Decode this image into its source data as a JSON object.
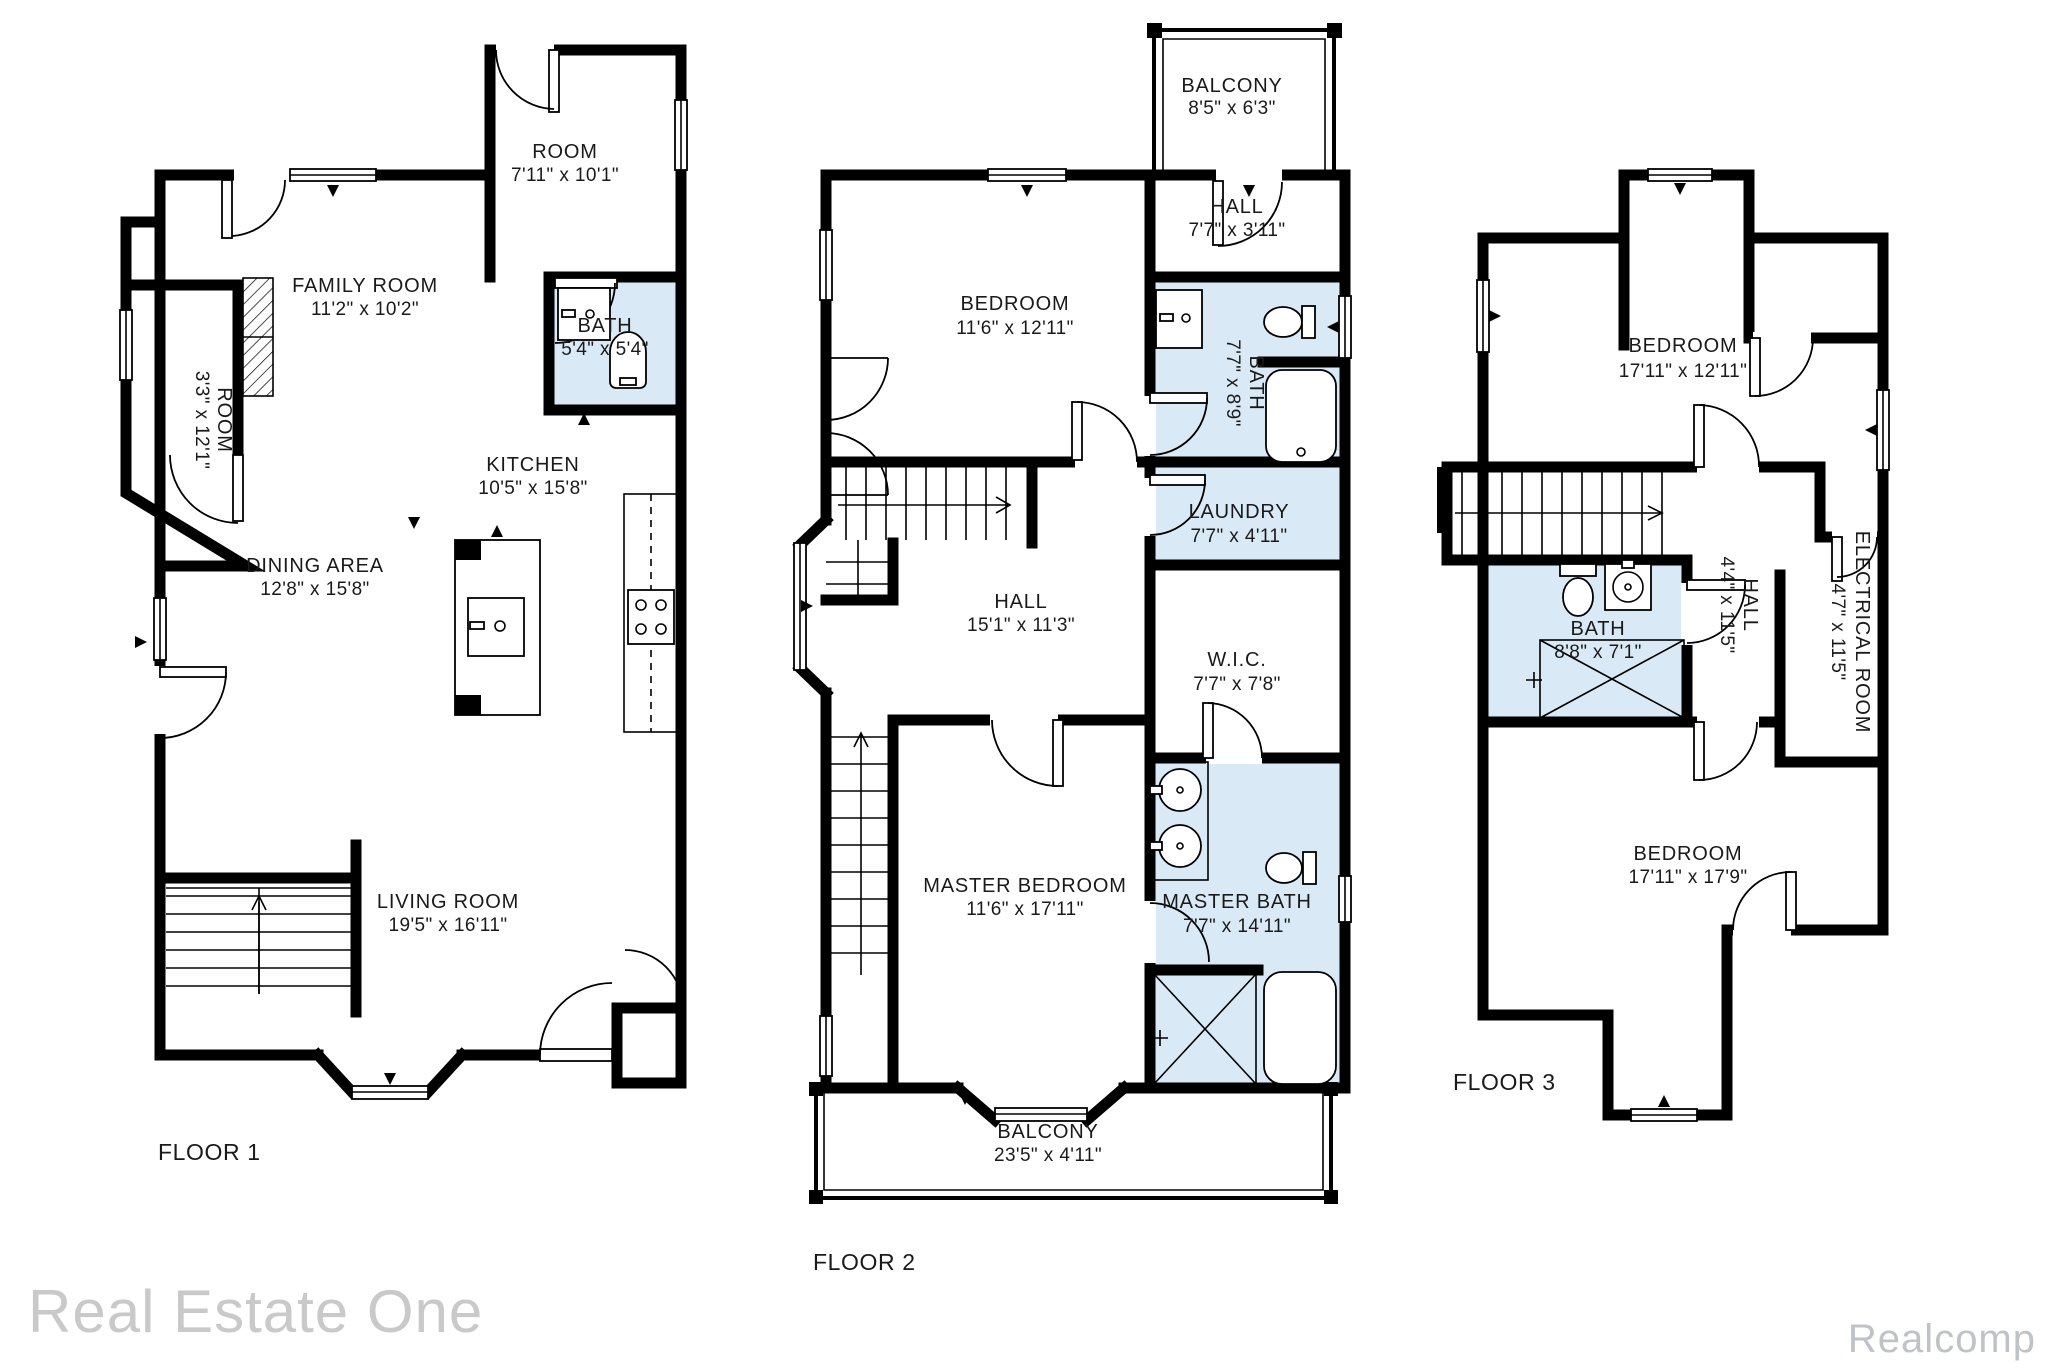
{
  "colors": {
    "wall": "#000000",
    "bath_fill": "#d9eaf6",
    "label_text": "#1a1a1a",
    "watermark_left": "#c9c9c9",
    "watermark_right": "#bfc3c7"
  },
  "watermarks": {
    "left": "Real Estate One",
    "right": "Realcomp"
  },
  "floors": [
    {
      "label": "FLOOR 1",
      "rooms": [
        {
          "name": "ROOM",
          "dims": "7'11\" x 10'1\""
        },
        {
          "name": "FAMILY ROOM",
          "dims": "11'2\" x 10'2\""
        },
        {
          "name": "BATH",
          "dims": "5'4\" x 5'4\""
        },
        {
          "name": "ROOM",
          "dims": "3'3\" x 12'1\""
        },
        {
          "name": "KITCHEN",
          "dims": "10'5\" x 15'8\""
        },
        {
          "name": "DINING AREA",
          "dims": "12'8\" x 15'8\""
        },
        {
          "name": "LIVING ROOM",
          "dims": "19'5\" x 16'11\""
        }
      ]
    },
    {
      "label": "FLOOR 2",
      "rooms": [
        {
          "name": "BALCONY",
          "dims": "8'5\" x 6'3\""
        },
        {
          "name": "HALL",
          "dims": "7'7\" x 3'11\""
        },
        {
          "name": "BEDROOM",
          "dims": "11'6\" x 12'11\""
        },
        {
          "name": "BATH",
          "dims": "7'7\" x 8'9\""
        },
        {
          "name": "LAUNDRY",
          "dims": "7'7\" x 4'11\""
        },
        {
          "name": "HALL",
          "dims": "15'1\" x 11'3\""
        },
        {
          "name": "W.I.C.",
          "dims": "7'7\" x 7'8\""
        },
        {
          "name": "MASTER BEDROOM",
          "dims": "11'6\" x 17'11\""
        },
        {
          "name": "MASTER BATH",
          "dims": "7'7\" x 14'11\""
        },
        {
          "name": "BALCONY",
          "dims": "23'5\" x 4'11\""
        }
      ]
    },
    {
      "label": "FLOOR 3",
      "rooms": [
        {
          "name": "BEDROOM",
          "dims": "17'11\" x 12'11\""
        },
        {
          "name": "BATH",
          "dims": "8'8\" x 7'1\""
        },
        {
          "name": "HALL",
          "dims": "4'4\" x 11'5\""
        },
        {
          "name": "ELECTRICAL ROOM",
          "dims": "4'7\" x 11'5\""
        },
        {
          "name": "BEDROOM",
          "dims": "17'11\" x 17'9\""
        }
      ]
    }
  ]
}
